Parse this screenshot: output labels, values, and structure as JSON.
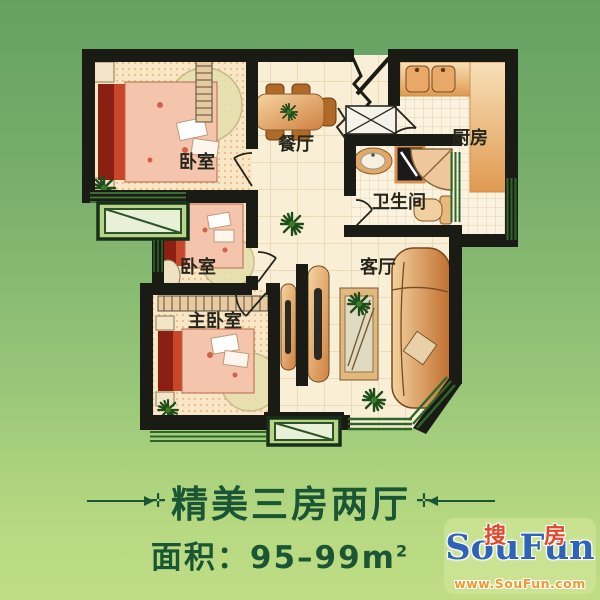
{
  "floorplan": {
    "rooms": {
      "bedroom1": "卧室",
      "bedroom2": "卧室",
      "master": "主卧室",
      "dining": "餐厅",
      "kitchen": "厨房",
      "bathroom": "卫生间",
      "living": "客厅"
    },
    "colors": {
      "wall": "#1b1b15",
      "floor": "#f9eed6",
      "bedroom_floor": "#f8e6c4",
      "window_green": "#2e6629",
      "furniture_wood": "#cf8040",
      "bed_red": "#8c1f14",
      "bed_pink": "#f4c4ac"
    }
  },
  "caption": {
    "title": "精美三房两厅",
    "deco_cross": "✛",
    "area_label": "面积：",
    "area_value": "95–99m",
    "area_sup": "2"
  },
  "logo": {
    "cn_first": "搜",
    "cn_second": "房",
    "en": "SouFun",
    "url": "www.SouFun.com"
  },
  "background": {
    "top": "#65a162",
    "bottom": "#bfdd85"
  }
}
